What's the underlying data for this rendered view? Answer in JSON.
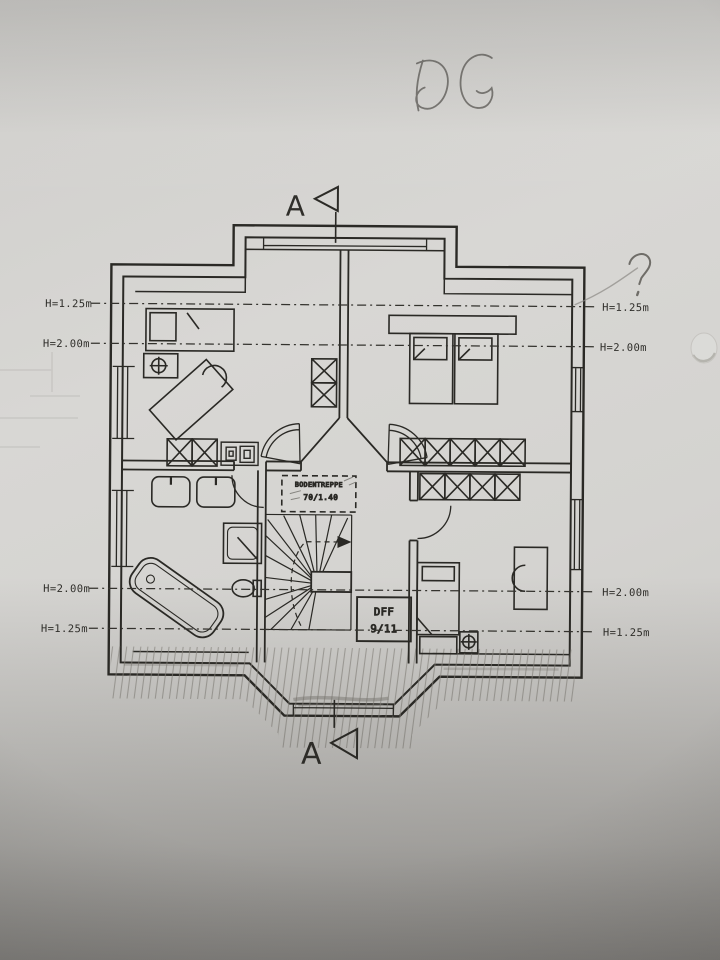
{
  "handwriting": {
    "floor_label": "DG",
    "question_mark": "?"
  },
  "section_markers": {
    "top": "A",
    "bottom": "A"
  },
  "height_labels": {
    "left": [
      "H=1.25m",
      "H=2.00m",
      "H=2.00m",
      "H=1.25m"
    ],
    "right": [
      "H=1.25m",
      "H=2.00m",
      "H=2.00m",
      "H=1.25m"
    ]
  },
  "stair": {
    "attic_hatch": {
      "line1": "BODENTREPPE",
      "line2": "70/1.40"
    }
  },
  "roof_window": {
    "line1": "DFF",
    "line2": "9/11"
  },
  "colors": {
    "paper": "#d3d2cf",
    "ink": "#2a2925",
    "pencil": "#6e6c67"
  }
}
